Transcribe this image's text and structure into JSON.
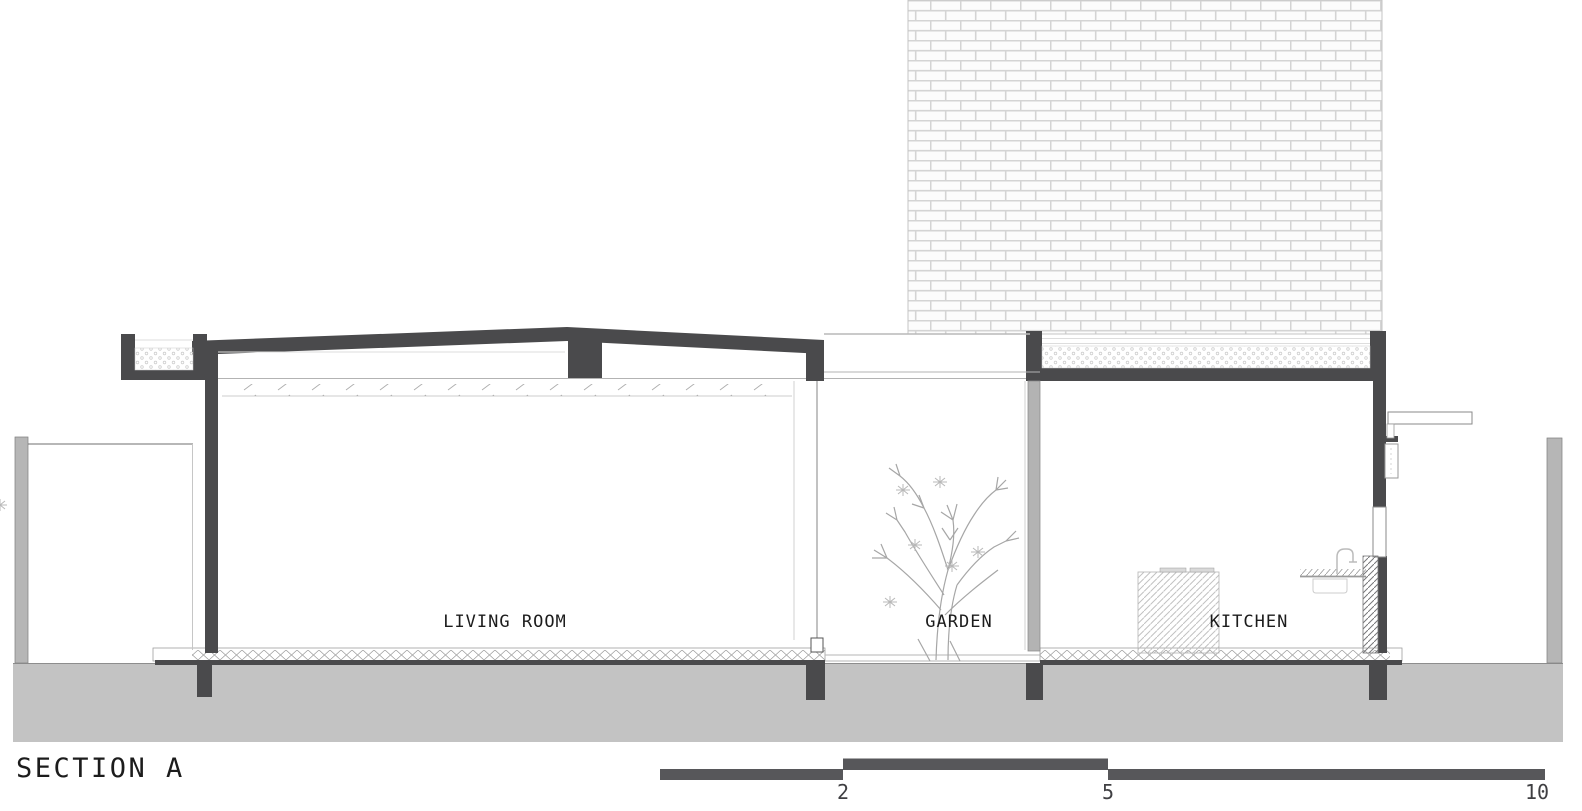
{
  "drawing": {
    "type": "architectural-section",
    "title": "SECTION A",
    "rooms": {
      "living_room": "LIVING ROOM",
      "garden": "GARDEN",
      "kitchen": "KITCHEN"
    },
    "scale_bar": {
      "tick_2": "2",
      "tick_5": "5",
      "tick_10": "10"
    },
    "colors": {
      "structure_dark": "#4a4a4c",
      "ground": "#c3c3c3",
      "boundary_wall": "#b6b6b6",
      "column_light": "#b3b3b3",
      "scale_bar": "#57575a",
      "text": "#1c1c1c",
      "background": "#ffffff"
    }
  }
}
